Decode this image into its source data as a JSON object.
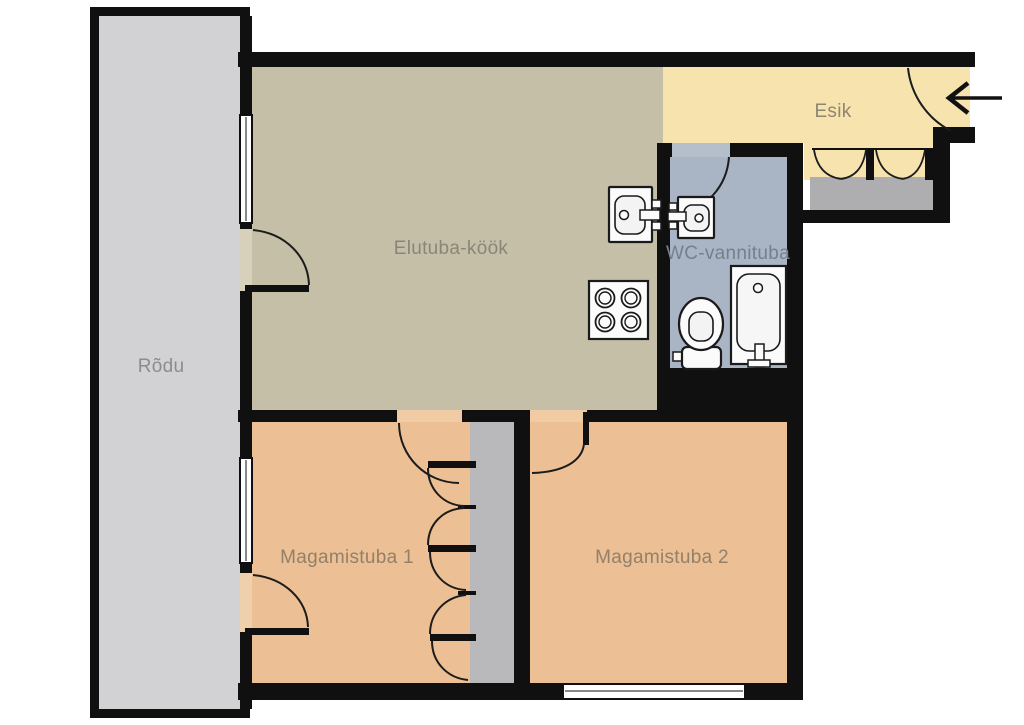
{
  "plan": {
    "type": "apartment-floor-plan",
    "language": "Estonian"
  },
  "rooms": {
    "rodu": {
      "label": "Rõdu",
      "color": "#d2d2d4",
      "label_color": "#8c8c8c"
    },
    "elutuba": {
      "label": "Elutuba-köök",
      "color": "#c5bfa7",
      "label_color": "#8b8578"
    },
    "esik": {
      "label": "Esik",
      "color": "#f6e3ad",
      "label_color": "#8d8672"
    },
    "wc": {
      "label": "WC-vannituba",
      "color": "#a9b5c5",
      "label_color": "#76808c"
    },
    "magamistuba1": {
      "label": "Magamistuba 1",
      "color": "#ecc094",
      "label_color": "#92806a"
    },
    "magamistuba2": {
      "label": "Magamistuba 2",
      "color": "#ecc094",
      "label_color": "#92806a"
    }
  },
  "palette": {
    "wall": "#101010",
    "door_arc": "#1c1c1c",
    "closet_floor": "#b9b9bb",
    "wardrobe_floor": "#aeaeb0",
    "window_fill": "#ffffff",
    "fixture_stroke": "#1a1a1a",
    "fixture_fill": "#fbfbfb",
    "fixture_inner": "#f3f3f3",
    "opening_beige": "#d7d1bb",
    "opening_orange": "#eed0ad",
    "opening_orange_bright": "#f1cba4",
    "opening_blue": "#b5bfcc",
    "arrow": "#111111",
    "background": "#ffffff"
  }
}
